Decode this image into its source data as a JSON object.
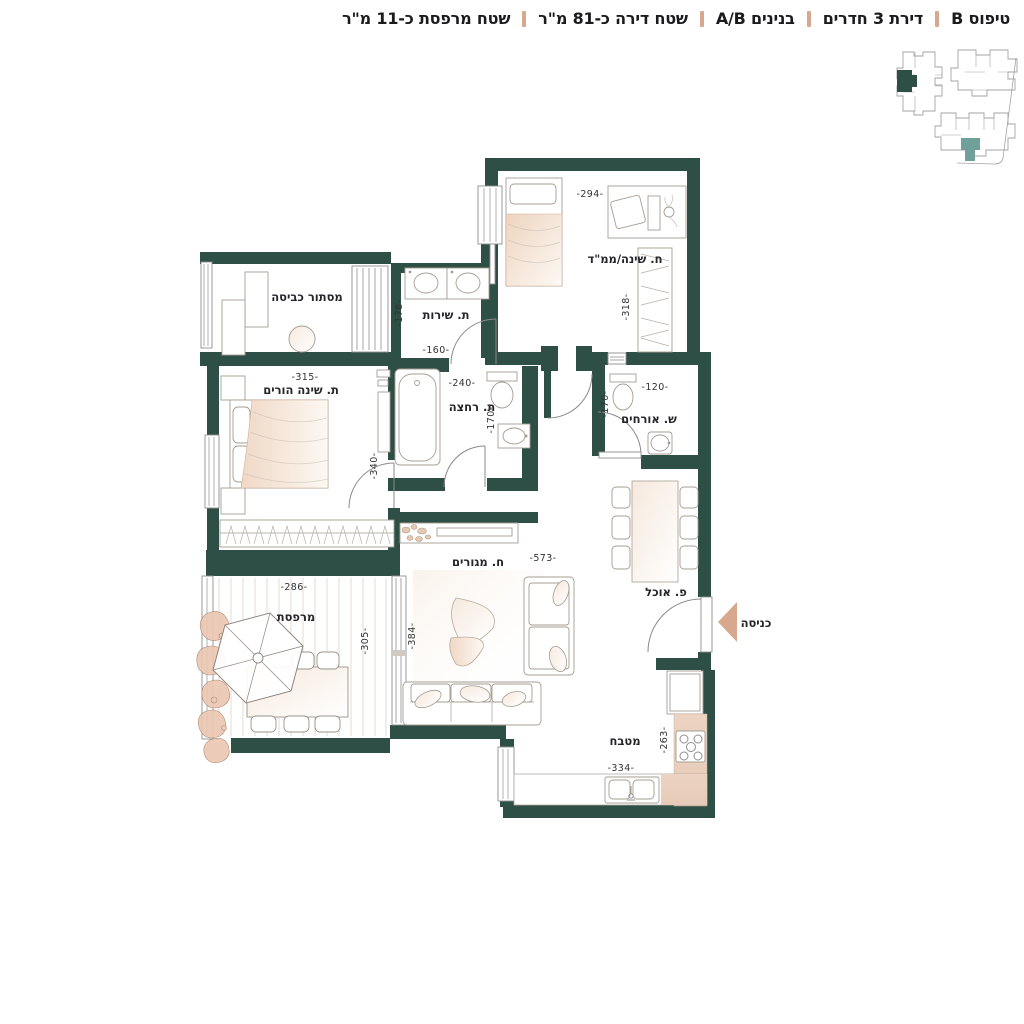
{
  "header": {
    "items": [
      {
        "label": "טיפוס B"
      },
      {
        "label": "דירת 3 חדרים"
      },
      {
        "label": "בנינים A/B"
      },
      {
        "label": "שטח דירה כ-81 מ\"ר"
      },
      {
        "label": "שטח מרפסת כ-11 מ\"ר"
      }
    ]
  },
  "floorplan": {
    "rooms": {
      "mamad": {
        "name": "ח. שינה/ממ\"ד",
        "dim_w": "-294-",
        "dim_h": "-318-"
      },
      "laundry": {
        "name": "מסתור כביסה"
      },
      "service": {
        "name": "ת. שירות",
        "dim_w": "-160-",
        "dim_h": "-178-"
      },
      "parents": {
        "name": "ת. שינה הורים",
        "dim_w": "-315-",
        "dim_h": "-340-"
      },
      "bath": {
        "name": "ת. רחצה",
        "dim_w": "-240-",
        "dim_h": "-170-"
      },
      "guest_wc": {
        "name": "ש. אורחים",
        "dim_w": "-120-",
        "dim_h": "-170-"
      },
      "living": {
        "name": "ח. מגורים",
        "dim_w": "-573-",
        "dim_h": "-384-"
      },
      "dining": {
        "name": "פ. אוכל"
      },
      "balcony": {
        "name": "מרפסת",
        "dim_w": "-286-",
        "dim_h": "-305-"
      },
      "kitchen": {
        "name": "מטבח",
        "dim_w": "-334-",
        "dim_h": "-263-"
      },
      "entrance": {
        "name": "כניסה"
      }
    }
  },
  "colors": {
    "wall": "#2e4f45",
    "accent": "#d7a78e",
    "teal": "#6fa09a",
    "counter": "#ead2c1",
    "ink": "#1b1b1d"
  }
}
